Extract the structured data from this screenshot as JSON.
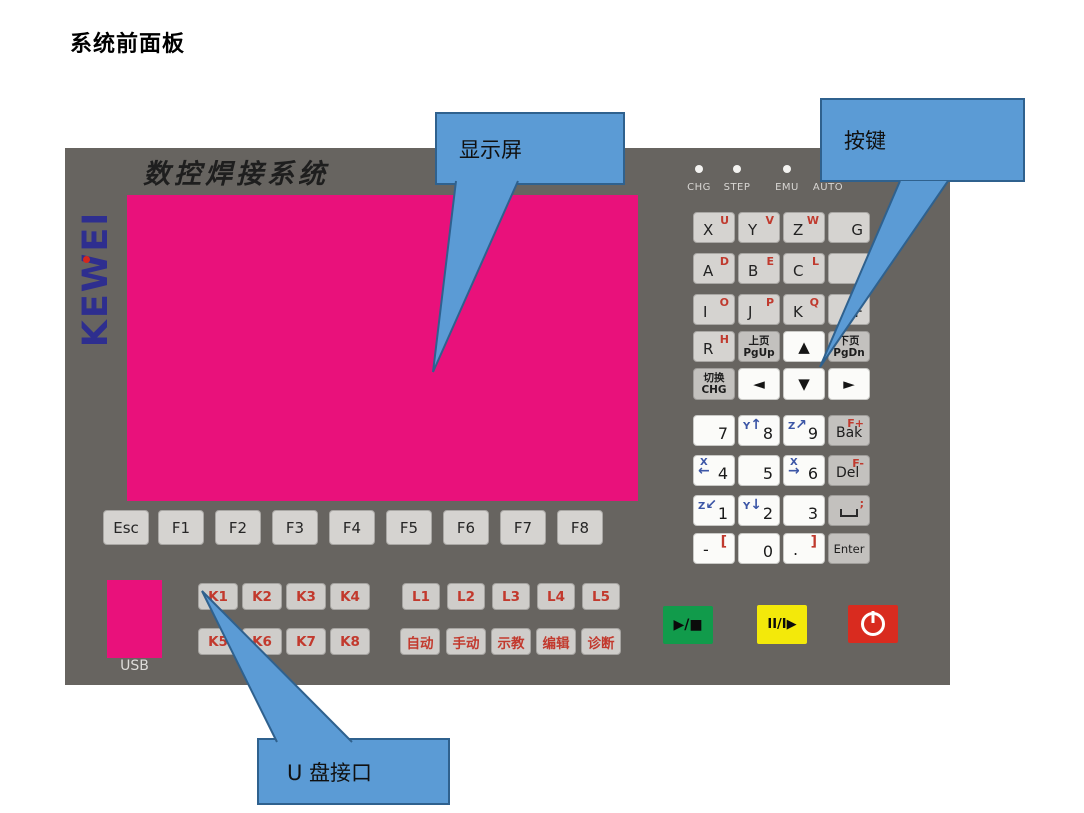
{
  "page": {
    "title": "系统前面板"
  },
  "panel": {
    "brand": "KEWEI",
    "heading": "数控焊接系统",
    "usb_label": "USB"
  },
  "callouts": {
    "display": {
      "label": "显示屏"
    },
    "keys": {
      "label": "按键"
    },
    "usb": {
      "label": "U 盘接口"
    }
  },
  "leds": [
    {
      "label": "CHG"
    },
    {
      "label": "STEP"
    },
    {
      "label": "EMU"
    },
    {
      "label": "AUTO"
    }
  ],
  "letter_keys": [
    {
      "main": "X",
      "sup": "U"
    },
    {
      "main": "Y",
      "sup": "V"
    },
    {
      "main": "Z",
      "sup": "W"
    },
    {
      "main": "G",
      "sup": ""
    },
    {
      "main": "A",
      "sup": "D"
    },
    {
      "main": "B",
      "sup": "E"
    },
    {
      "main": "C",
      "sup": "L"
    },
    {
      "main": "",
      "sup": ""
    },
    {
      "main": "I",
      "sup": "O"
    },
    {
      "main": "J",
      "sup": "P"
    },
    {
      "main": "K",
      "sup": "Q"
    },
    {
      "main": "F",
      "sup": "N"
    },
    {
      "main": "R",
      "sup": "H"
    }
  ],
  "nav_keys": {
    "pgup": {
      "line1": "上页",
      "line2": "PgUp"
    },
    "pgdn": {
      "line1": "下页",
      "line2": "PgDn"
    },
    "chg": {
      "line1": "切换",
      "line2": "CHG"
    },
    "up": "▲",
    "down": "▼",
    "left": "◄",
    "right": "►"
  },
  "numpad": {
    "d7": {
      "num": "7"
    },
    "d8": {
      "num": "8",
      "axis": "Y",
      "arrow": "↑"
    },
    "d9": {
      "num": "9",
      "axis": "Z",
      "arrow": "↗"
    },
    "d4": {
      "num": "4",
      "axis": "X",
      "arrow": "←"
    },
    "d5": {
      "num": "5"
    },
    "d6": {
      "num": "6",
      "axis": "X",
      "arrow": "→"
    },
    "d1": {
      "num": "1",
      "axis": "Z",
      "arrow": "↙"
    },
    "d2": {
      "num": "2",
      "axis": "Y",
      "arrow": "↓"
    },
    "d3": {
      "num": "3"
    },
    "minus": {
      "num": "-",
      "sup": "["
    },
    "d0": {
      "num": "0"
    },
    "dot": {
      "num": ".",
      "sup": "]"
    },
    "bak": {
      "label": "Bak",
      "sup": "F+"
    },
    "del": {
      "label": "Del",
      "sup": "F-"
    },
    "space": {
      "sup": ";"
    },
    "enter": {
      "label": "Enter"
    }
  },
  "function_keys": [
    "Esc",
    "F1",
    "F2",
    "F3",
    "F4",
    "F5",
    "F6",
    "F7",
    "F8"
  ],
  "k_keys": [
    "K1",
    "K2",
    "K3",
    "K4",
    "K5",
    "K6",
    "K7",
    "K8"
  ],
  "l_keys": [
    "L1",
    "L2",
    "L3",
    "L4",
    "L5"
  ],
  "mode_keys": [
    "自动",
    "手动",
    "示教",
    "编辑",
    "诊断"
  ],
  "controls": {
    "start": {
      "glyph": "▶/■",
      "color": "#119B4B"
    },
    "pause": {
      "glyph": "II/I▶",
      "color": "#F3E90A"
    },
    "power": {
      "color": "#D92B1F"
    }
  },
  "colors": {
    "panel": "#676460",
    "screen": "#E9117B",
    "callout_fill": "#5B9BD5",
    "callout_border": "#2F618E",
    "key_red_text": "#C2392D",
    "key_blue_text": "#3C56A6",
    "logo_blue": "#2E2E8F"
  }
}
